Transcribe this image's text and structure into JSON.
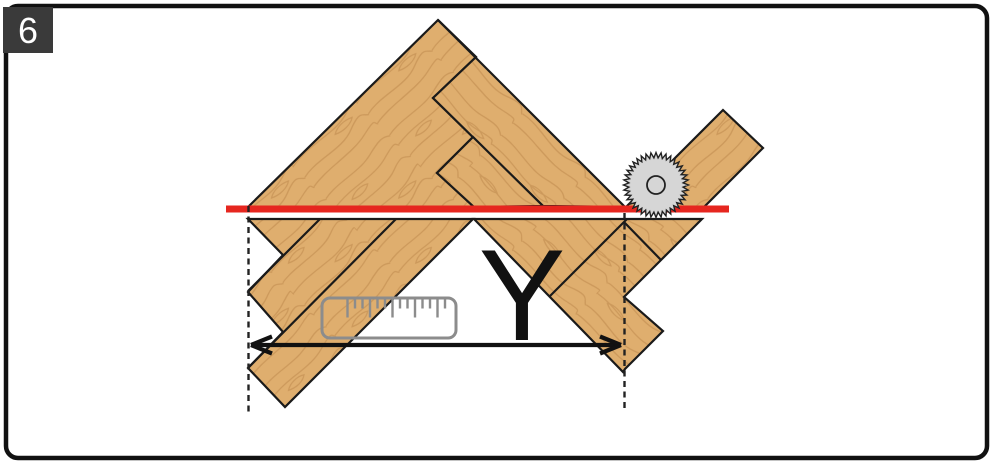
{
  "figure": {
    "step_label": "6",
    "dimension_label": "Y",
    "description": "Herringbone flooring panel cut diagram with circular saw blade, cutting line and width measurement Y"
  },
  "colors": {
    "background": "#ffffff",
    "border": "#111111",
    "badge_bg": "#3a3a3a",
    "badge_text": "#ffffff",
    "wood_base": "#dfae6e",
    "wood_grain": "#c08a4e",
    "outline": "#1a1a1a",
    "cut_line_red": "#e6261f",
    "blade_fill": "#d6d6d6",
    "blade_stroke": "#222222",
    "measure_gray": "#8c8c8c",
    "dimension_black": "#111111"
  },
  "icons": [
    {
      "name": "circular-saw-blade-icon"
    },
    {
      "name": "ruler-icon"
    },
    {
      "name": "double-arrow-measure-icon"
    }
  ]
}
